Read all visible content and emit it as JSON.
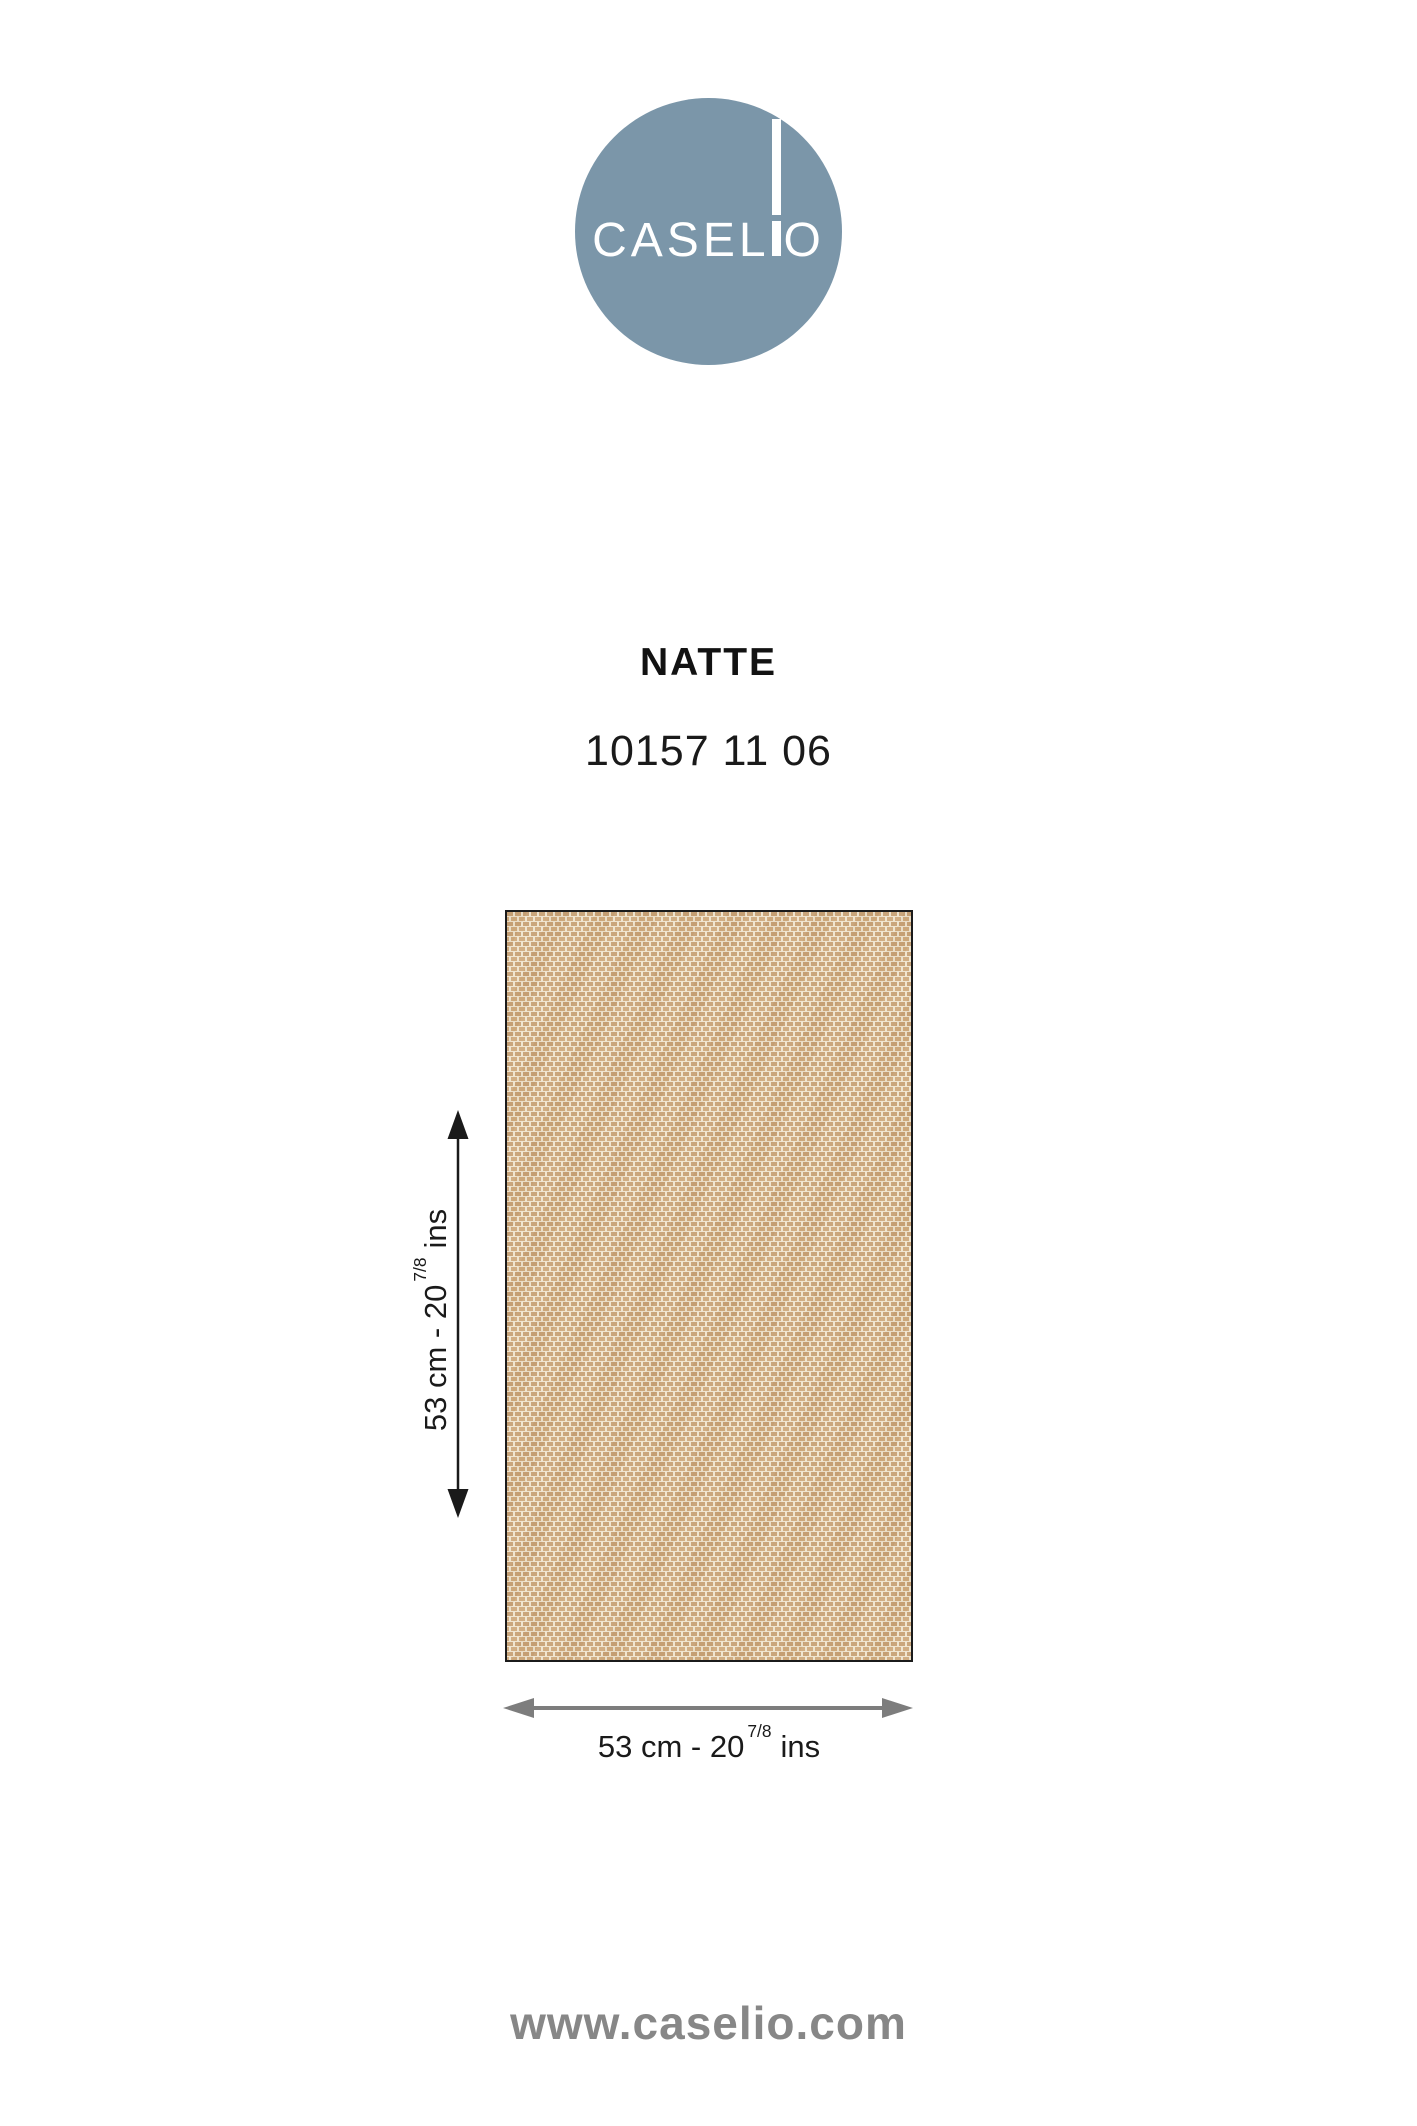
{
  "brand": {
    "name": "CASELIO",
    "wordmark_left": "CASEL",
    "wordmark_right": "O",
    "circle_color": "#7b96a9",
    "wordmark_color": "#ffffff"
  },
  "product": {
    "name": "NATTE",
    "reference": "10157 11 06"
  },
  "swatch": {
    "texture": "woven-natte-beige",
    "base_color": "#efe4ce",
    "weave_colors": [
      "#c7a175",
      "#cfaa7d"
    ],
    "border_color": "#1b1b1b"
  },
  "dimensions": {
    "height": {
      "prefix": "53 cm - 20",
      "fraction": "7/8",
      "suffix": "ins"
    },
    "width": {
      "prefix": "53 cm - 20",
      "fraction": "7/8",
      "suffix": "ins"
    },
    "height_arrow_color": "#1a1a1a",
    "width_arrow_color": "#7d7d7d"
  },
  "icons": {
    "height_arrow": "double-headed-vertical-arrow",
    "width_arrow": "double-headed-horizontal-arrow"
  },
  "footer": {
    "website": "www.caselio.com",
    "color": "#878787"
  }
}
